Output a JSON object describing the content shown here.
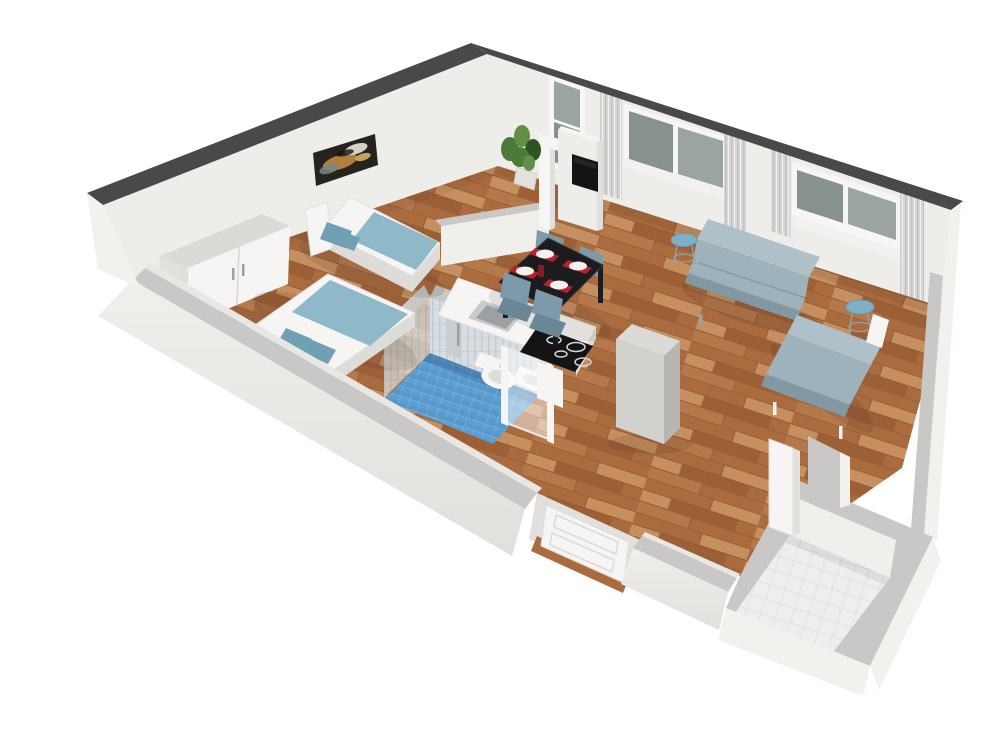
{
  "scene": {
    "title": "3D isometric cutaway floor plan render of a one-bedroom apartment with wood floors",
    "style": "architectural 3D render, white background, walls cut away at mid height",
    "rooms": [
      {
        "id": "bedroom",
        "label": "Sleeping area",
        "furniture": [
          "white two-door wardrobe",
          "single bed with blue blanket",
          "double bed with four blue pillows",
          "abstract wall art"
        ]
      },
      {
        "id": "bathroom",
        "label": "Bathroom",
        "furniture": [
          "blue mosaic tile floor",
          "chrome shower column",
          "wall-hung toilet",
          "washbasin",
          "glass shower partition"
        ]
      },
      {
        "id": "kitchen",
        "label": "Kitchen",
        "furniture": [
          "white counter with inset sink",
          "black induction cooktop with 4 burners",
          "tall gray cabinet"
        ]
      },
      {
        "id": "dining",
        "label": "Dining area",
        "furniture": [
          "black dining table",
          "4 blue chairs",
          "4 white plates on red placemats",
          "small vase"
        ]
      },
      {
        "id": "living",
        "label": "Living room",
        "furniture": [
          "gray-blue sofa",
          "daybed along right wall",
          "2 round blue side tables",
          "wall-mounted TV on partition",
          "potted plant"
        ]
      },
      {
        "id": "entry",
        "label": "Entrance hall",
        "furniture": [
          "white square tile floor",
          "open white door",
          "white panel front door"
        ]
      }
    ],
    "counts": {
      "windows": 4,
      "curtain_panels": 5,
      "doors": 3,
      "dining_chairs": 4,
      "place_settings": 4,
      "beds": 2,
      "sofas": 2,
      "side_tables": 2
    }
  },
  "palette": {
    "bg": "#ffffff",
    "wall_top": "#47494b",
    "wall_face": "#efedea",
    "wall_face_shade": "#e2e0dd",
    "wall_left_face": "#f3f1ee",
    "wall_cut_top": "#c9c8c6",
    "wall_cut_face": "#f1efec",
    "wall_inner_lip": "#e9e7e4",
    "wood_base": "#b5784a",
    "wood_dark": "#9c5f36",
    "wood_mid": "#aa6c3f",
    "wood_light": "#c68f5f",
    "wood_seam": "#7e4c2b",
    "bath_floor": "#5b9ed2",
    "bath_floor_dark": "#4a86b8",
    "bath_wall": "#d7dde0",
    "bath_wall_stripe": "#c2ccd2",
    "entry_tile": "#eceeef",
    "entry_grout": "#d8dadc",
    "window_glass": "#87928e",
    "window_glass_light": "#9aa5a1",
    "window_frame": "#f7f6f4",
    "curtain": "#d8d7d5",
    "curtain_stripe": "#c1c0be",
    "sill": "#f2f1ef",
    "textile": "#8fb9c9",
    "textile_dark": "#6fa0b4",
    "bed_white": "#f6f5f3",
    "bed_shadow": "#dedcd9",
    "sofa": "#9db2ba",
    "sofa_light": "#aec1c9",
    "sofa_dark": "#8298a2",
    "side_table": "#7fb0c8",
    "side_table_dark": "#6b98ad",
    "table_black": "#1c1b1d",
    "table_edge": "#3a383b",
    "chair": "#7d9aaa",
    "chair_dark": "#6a8796",
    "plate": "#f2f1ee",
    "placemat": "#b5232e",
    "vase": "#7e1f28",
    "tv": "#141417",
    "metal": "#c7cbcc",
    "metal_dark": "#9aa0a3",
    "fridge_top": "#dcdad7",
    "fridge_light": "#d3d1ce",
    "fridge_dark": "#b7b5b2",
    "plant_green": "#4c7a39",
    "plant_green_dark": "#2f5424",
    "plant_green_light": "#618f48",
    "plant_pot": "#e3e1de",
    "art_bg": "#26231f",
    "art_amber": "#c08a3e",
    "art_gold": "#d8b05e",
    "art_cream": "#e8e4d8",
    "art_teal": "#79888a"
  }
}
